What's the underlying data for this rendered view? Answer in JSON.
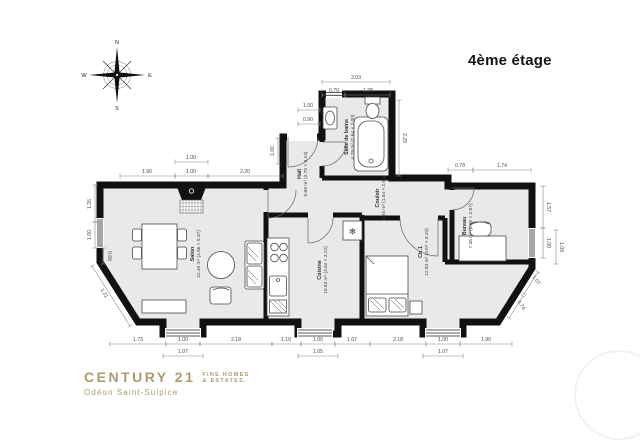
{
  "title": "4ème étage",
  "compass": {
    "n": "N",
    "e": "E",
    "s": "S",
    "w": "W"
  },
  "logo": {
    "brand": "CENTURY 21",
    "tagline_line1": "FINE HOMES",
    "tagline_line2": "& ESTATES.",
    "agency": "Odéon Saint-Sulpice",
    "color": "#ab9a70",
    "watermark": "21"
  },
  "plan": {
    "wall_color": "#111111",
    "floor_color": "#e9e9ea",
    "fridge_icon": "❄",
    "rooms": [
      {
        "name": "Salon",
        "area": "22.49 m²",
        "dims": "(4.86 × 5.37)",
        "x": 194,
        "y": 254
      },
      {
        "name": "Cuisine",
        "area": "10.93 m²",
        "dims": "(3.62 × 3.22)",
        "x": 321,
        "y": 270
      },
      {
        "name": "Ch.1",
        "area": "12.93 m²",
        "dims": "(3.67 × 3.20)",
        "x": 422,
        "y": 252
      },
      {
        "name": "Bureau",
        "area": "7.36 m²",
        "dims": "(2.89 × 2.87)",
        "x": 466,
        "y": 226
      },
      {
        "name": "Salle de bains",
        "area": "4.79 m²",
        "dims": "(2.64 × 2.00)",
        "x": 348,
        "y": 137
      },
      {
        "name": "Hall",
        "area": "5.68 m²",
        "dims": "(2.75 × 3.24)",
        "x": 301,
        "y": 174
      },
      {
        "name": "Couloir",
        "area": "2.84 m²",
        "dims": "(1.54 × 2.61)",
        "x": 379,
        "y": 198
      }
    ],
    "dimensions": [
      {
        "v": "1.90",
        "x1": 120,
        "y1": 176,
        "x2": 175,
        "y2": 176,
        "lx": 147,
        "ly": 173,
        "r": 0
      },
      {
        "v": "1.00",
        "x1": 175,
        "y1": 162,
        "x2": 208,
        "y2": 162,
        "lx": 191,
        "ly": 159,
        "r": 0
      },
      {
        "v": "1.00",
        "x1": 175,
        "y1": 176,
        "x2": 208,
        "y2": 176,
        "lx": 191,
        "ly": 173,
        "r": 0
      },
      {
        "v": "2.20",
        "x1": 208,
        "y1": 176,
        "x2": 283,
        "y2": 176,
        "lx": 245,
        "ly": 173,
        "r": 0
      },
      {
        "v": "2.03",
        "x1": 322,
        "y1": 82,
        "x2": 390,
        "y2": 82,
        "lx": 356,
        "ly": 79,
        "r": 0
      },
      {
        "v": "0.70",
        "x1": 322,
        "y1": 95,
        "x2": 345,
        "y2": 95,
        "lx": 334,
        "ly": 92,
        "r": 0
      },
      {
        "v": "1.28",
        "x1": 345,
        "y1": 95,
        "x2": 390,
        "y2": 95,
        "lx": 368,
        "ly": 92,
        "r": 0
      },
      {
        "v": "2.29",
        "x1": 399,
        "y1": 100,
        "x2": 399,
        "y2": 176,
        "lx": 403,
        "ly": 138,
        "r": 90
      },
      {
        "v": "1.00",
        "x1": 298,
        "y1": 110,
        "x2": 320,
        "y2": 110,
        "lx": 308,
        "ly": 107,
        "r": 0
      },
      {
        "v": "0.90",
        "x1": 298,
        "y1": 124,
        "x2": 320,
        "y2": 124,
        "lx": 308,
        "ly": 121,
        "r": 0
      },
      {
        "v": "1.00",
        "x1": 278,
        "y1": 138,
        "x2": 278,
        "y2": 164,
        "lx": 274,
        "ly": 151,
        "r": -90
      },
      {
        "v": "0.78",
        "x1": 448,
        "y1": 170,
        "x2": 473,
        "y2": 170,
        "lx": 460,
        "ly": 167,
        "r": 0
      },
      {
        "v": "1.74",
        "x1": 473,
        "y1": 170,
        "x2": 531,
        "y2": 170,
        "lx": 502,
        "ly": 167,
        "r": 0
      },
      {
        "v": "1.57",
        "x1": 543,
        "y1": 186,
        "x2": 543,
        "y2": 228,
        "lx": 547,
        "ly": 207,
        "r": 90
      },
      {
        "v": "1.00",
        "x1": 543,
        "y1": 228,
        "x2": 543,
        "y2": 258,
        "lx": 547,
        "ly": 243,
        "r": 90
      },
      {
        "v": "1.09",
        "x1": 556,
        "y1": 230,
        "x2": 556,
        "y2": 264,
        "lx": 560,
        "ly": 247,
        "r": 90
      },
      {
        "v": "1.26",
        "x1": 95,
        "y1": 185,
        "x2": 95,
        "y2": 222,
        "lx": 91,
        "ly": 204,
        "r": -90
      },
      {
        "v": "1.00",
        "x1": 95,
        "y1": 222,
        "x2": 95,
        "y2": 248,
        "lx": 91,
        "ly": 235,
        "r": -90
      },
      {
        "v": "0.66",
        "x1": 103,
        "y1": 248,
        "x2": 103,
        "y2": 264,
        "lx": 108,
        "ly": 256,
        "r": 90
      },
      {
        "v": "1.31",
        "x1": 92,
        "y1": 266,
        "x2": 130,
        "y2": 326,
        "lx": 103,
        "ly": 294,
        "r": 58
      },
      {
        "v": "1.73",
        "x1": 110,
        "y1": 344,
        "x2": 166,
        "y2": 344,
        "lx": 138,
        "ly": 341,
        "r": 0
      },
      {
        "v": "1.00",
        "x1": 166,
        "y1": 344,
        "x2": 200,
        "y2": 344,
        "lx": 183,
        "ly": 341,
        "r": 0
      },
      {
        "v": "2.18",
        "x1": 200,
        "y1": 344,
        "x2": 272,
        "y2": 344,
        "lx": 236,
        "ly": 341,
        "r": 0
      },
      {
        "v": "1.10",
        "x1": 272,
        "y1": 344,
        "x2": 301,
        "y2": 344,
        "lx": 286,
        "ly": 341,
        "r": 0
      },
      {
        "v": "1.00",
        "x1": 301,
        "y1": 344,
        "x2": 335,
        "y2": 344,
        "lx": 318,
        "ly": 341,
        "r": 0
      },
      {
        "v": "1.07",
        "x1": 335,
        "y1": 344,
        "x2": 370,
        "y2": 344,
        "lx": 352,
        "ly": 341,
        "r": 0
      },
      {
        "v": "2.18",
        "x1": 370,
        "y1": 344,
        "x2": 426,
        "y2": 344,
        "lx": 398,
        "ly": 341,
        "r": 0
      },
      {
        "v": "1.00",
        "x1": 426,
        "y1": 344,
        "x2": 460,
        "y2": 344,
        "lx": 443,
        "ly": 341,
        "r": 0
      },
      {
        "v": "1.90",
        "x1": 460,
        "y1": 344,
        "x2": 512,
        "y2": 344,
        "lx": 486,
        "ly": 341,
        "r": 0
      },
      {
        "v": "1.07",
        "x1": 163,
        "y1": 356,
        "x2": 203,
        "y2": 356,
        "lx": 183,
        "ly": 353,
        "r": 0
      },
      {
        "v": "1.05",
        "x1": 298,
        "y1": 356,
        "x2": 338,
        "y2": 356,
        "lx": 318,
        "ly": 353,
        "r": 0
      },
      {
        "v": "1.07",
        "x1": 423,
        "y1": 356,
        "x2": 463,
        "y2": 356,
        "lx": 443,
        "ly": 353,
        "r": 0
      },
      {
        "v": "1.07",
        "x1": 538,
        "y1": 272,
        "x2": 524,
        "y2": 294,
        "lx": 535,
        "ly": 281,
        "r": 55
      },
      {
        "v": "0.74",
        "x1": 523,
        "y1": 296,
        "x2": 509,
        "y2": 318,
        "lx": 520,
        "ly": 306,
        "r": 55
      }
    ]
  }
}
